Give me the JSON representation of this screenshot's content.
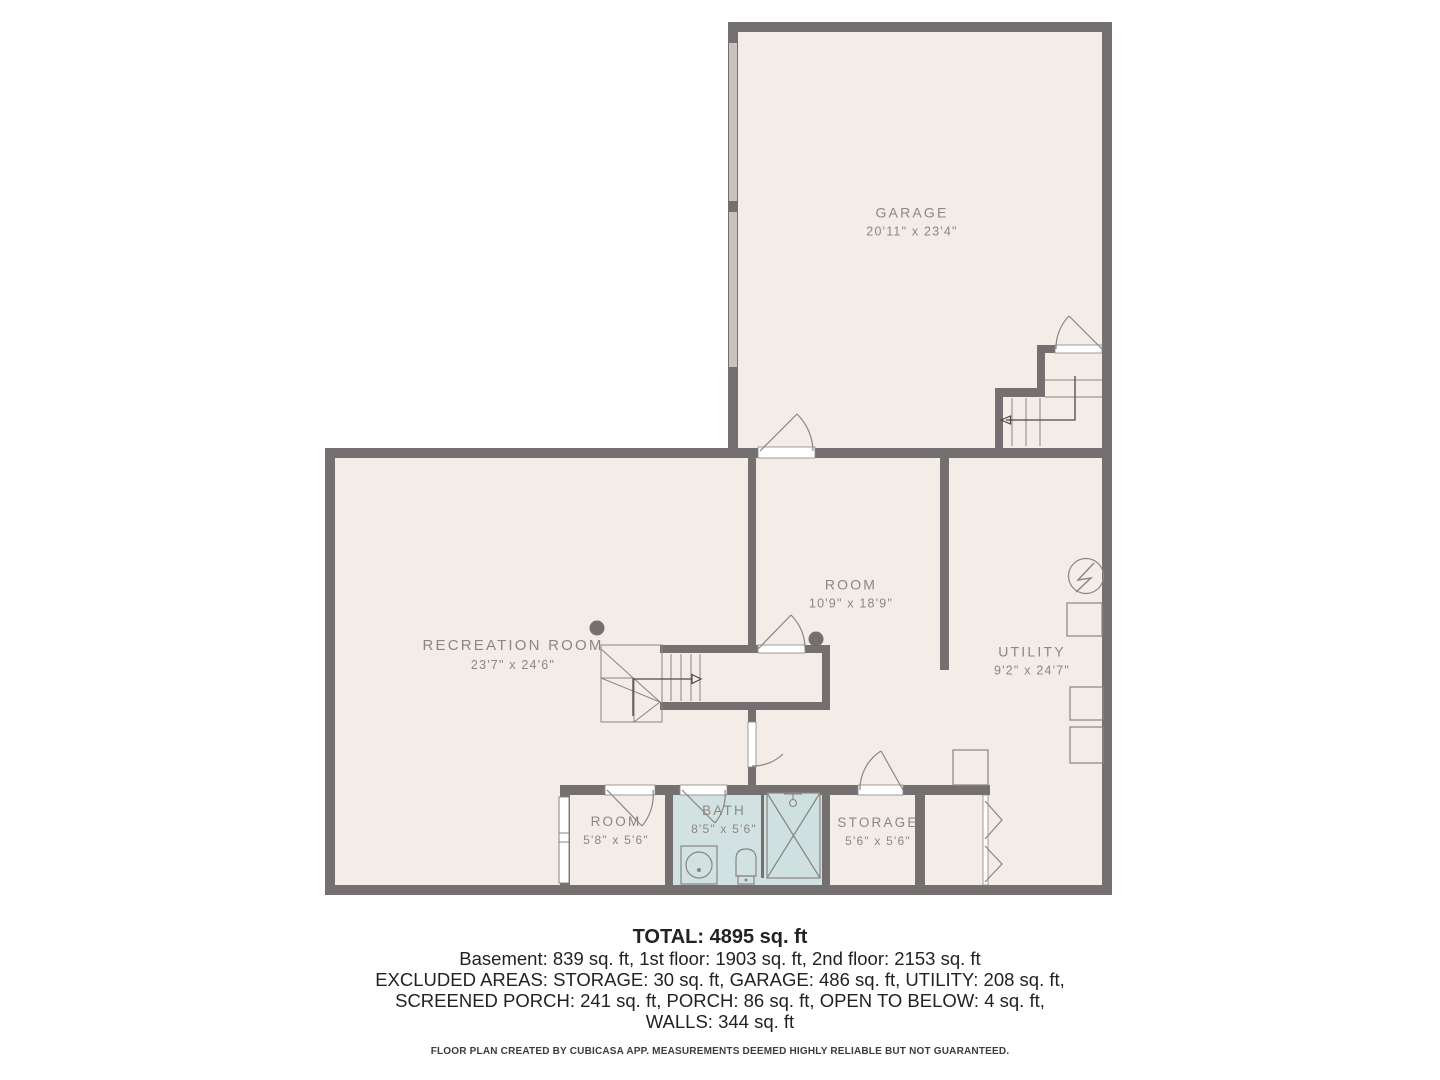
{
  "rooms": {
    "garage": {
      "name": "GARAGE",
      "dims": "20'11\" x 23'4\""
    },
    "recreation": {
      "name": "RECREATION ROOM",
      "dims": "23'7\" x 24'6\""
    },
    "room": {
      "name": "ROOM",
      "dims": "10'9\" x 18'9\""
    },
    "utility": {
      "name": "UTILITY",
      "dims": "9'2\" x 24'7\""
    },
    "small_room": {
      "name": "ROOM",
      "dims": "5'8\" x 5'6\""
    },
    "bath": {
      "name": "BATH",
      "dims": "8'5\" x 5'6\""
    },
    "storage": {
      "name": "STORAGE",
      "dims": "5'6\" x 5'6\""
    }
  },
  "summary": {
    "total": "TOTAL: 4895 sq. ft",
    "line1": "Basement: 839 sq. ft, 1st floor: 1903 sq. ft, 2nd floor: 2153 sq. ft",
    "line2": "EXCLUDED AREAS: STORAGE: 30 sq. ft, GARAGE: 486 sq. ft, UTILITY: 208 sq. ft,",
    "line3": "SCREENED PORCH: 241 sq. ft, PORCH: 86 sq. ft, OPEN TO BELOW: 4 sq. ft,",
    "line4": "WALLS: 344 sq. ft"
  },
  "footer": "FLOOR PLAN CREATED BY CUBICASA APP. MEASUREMENTS DEEMED HIGHLY RELIABLE BUT NOT GUARANTEED.",
  "colors": {
    "wall": "#757070",
    "floor": "#f4ece6",
    "bath_floor": "#d2e2e2",
    "garage_door_panel": "#c9c3bd",
    "fixture_line": "#8a8580",
    "label_text": "#8d8780",
    "summary_text": "#222222"
  },
  "icons": {
    "electrical_panel": "circle-with-lightning-bolt",
    "shower_head": "shower-spray",
    "sink": "square-basin-with-circle",
    "toilet": "bowl-with-tank",
    "bifold_door": "double-chevron",
    "stair_direction": "l-shaped-arrow",
    "column": "filled-dot"
  }
}
